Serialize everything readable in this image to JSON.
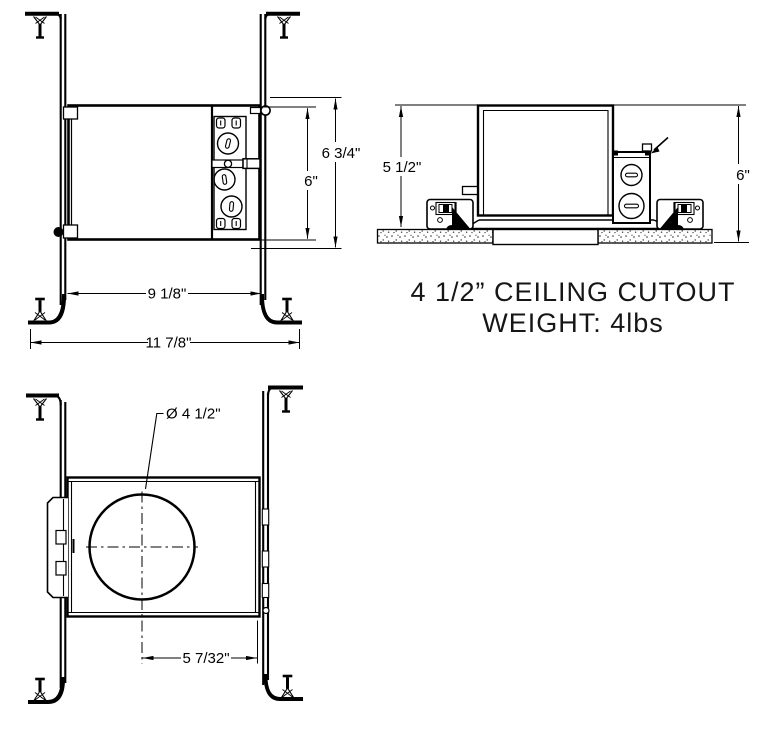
{
  "drawing": {
    "background": "#ffffff",
    "line_color": "#000000",
    "front_view": {
      "label": "front-view",
      "dims": {
        "overall_height": "6 3/4\"",
        "housing_height": "6\"",
        "housing_width": "9 1/8\"",
        "overall_width": "11 7/8\""
      }
    },
    "side_view": {
      "label": "side-view",
      "dims": {
        "above_ceiling_height": "5 1/2\"",
        "overall_height": "6\""
      },
      "caption": {
        "line1": "4 1/2” CEILING CUTOUT",
        "line2": "WEIGHT: 4lbs"
      }
    },
    "bottom_view": {
      "label": "bottom-view",
      "dims": {
        "aperture_diameter": "Ø 4 1/2\"",
        "center_to_edge": "5 7/32\""
      }
    }
  }
}
